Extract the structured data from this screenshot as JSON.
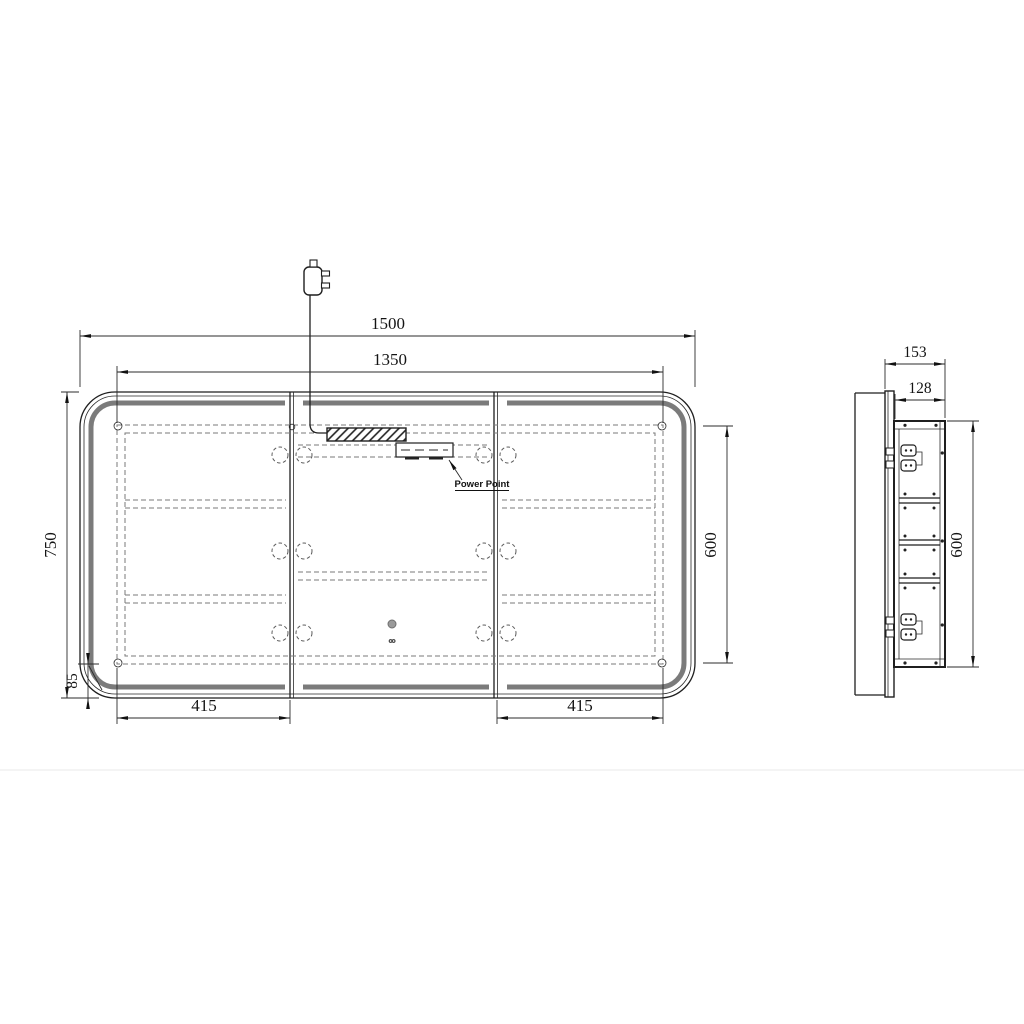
{
  "drawing": {
    "front": {
      "width_overall": "1500",
      "width_inner": "1350",
      "height_overall": "750",
      "height_inner": "600",
      "corner_offset": "85",
      "door_width_left": "415",
      "door_width_right": "415",
      "power_point": "Power Point"
    },
    "side": {
      "depth_overall": "153",
      "depth_body": "128",
      "height_body": "600"
    },
    "colors": {
      "line": "#1f1f1f",
      "led_band": "#7b7b7b",
      "dashed": "#7a7a7a",
      "background": "#ffffff"
    }
  }
}
